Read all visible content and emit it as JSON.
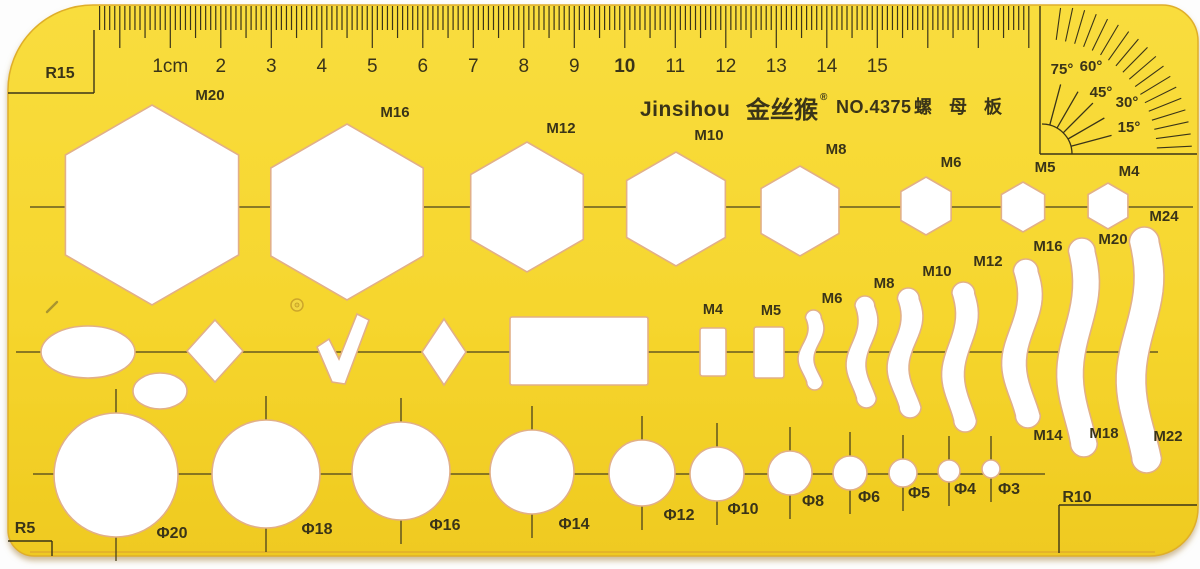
{
  "colors": {
    "background": "#fdfdfd",
    "plastic_top": "#f9dd3e",
    "plastic_mid": "#f6d62e",
    "plastic_bottom": "#efca20",
    "ink": "#3a3418",
    "line": "#4a421e",
    "cutout_fill": "#ffffff",
    "cutout_edge": "#e2b088",
    "edge_stroke": "#dfae2b",
    "shadow": "#a98545"
  },
  "brand": {
    "name_latin": "Jinsihou",
    "name_cn": "金丝猴",
    "registered": "®",
    "model": "NO.4375",
    "product": "螺 母 板"
  },
  "corner_radius_marks": {
    "top_left": "R15",
    "bottom_left": "R5",
    "bottom_right": "R10"
  },
  "ruler": {
    "labels": [
      "1cm",
      "2",
      "3",
      "4",
      "5",
      "6",
      "7",
      "8",
      "9",
      "10",
      "11",
      "12",
      "13",
      "14",
      "15"
    ],
    "first_label_x": 170.3,
    "cm_step": 50.5,
    "mm_step": 5.05,
    "tick_start_mm": -4,
    "tick_end_mm": 180,
    "top_y": 6
  },
  "protractor": {
    "origin": {
      "x": 1042,
      "y": 154
    },
    "box_v": {
      "x": 1040,
      "y1": 6,
      "y2": 154
    },
    "box_h": {
      "y": 154,
      "x1": 1040,
      "x2": 1197
    },
    "arc_r": 30,
    "ray_angles": [
      15,
      30,
      45,
      60,
      75
    ],
    "ray_r1": 30,
    "ray_r2": 72,
    "hatch_r1": 115,
    "hatch_r2": 150,
    "labels": [
      {
        "text": "75°",
        "x": 1062,
        "y": 74
      },
      {
        "text": "60°",
        "x": 1091,
        "y": 71
      },
      {
        "text": "45°",
        "x": 1101,
        "y": 97
      },
      {
        "text": "30°",
        "x": 1127,
        "y": 107
      },
      {
        "text": "15°",
        "x": 1129,
        "y": 132
      }
    ]
  },
  "guidelines": {
    "hex_row": {
      "y": 207,
      "x1": 30,
      "x2": 1193
    },
    "shape_row": {
      "y": 352,
      "x1": 16,
      "x2": 1158
    },
    "circle_row": {
      "y": 474,
      "x1": 33,
      "x2": 1045
    }
  },
  "hexagons": [
    {
      "label": "M20",
      "cx": 152,
      "cy": 205,
      "r": 100,
      "lx": 210,
      "ly": 100
    },
    {
      "label": "M16",
      "cx": 347,
      "cy": 212,
      "r": 88,
      "lx": 395,
      "ly": 117
    },
    {
      "label": "M12",
      "cx": 527,
      "cy": 207,
      "r": 65,
      "lx": 561,
      "ly": 133
    },
    {
      "label": "M10",
      "cx": 676,
      "cy": 209,
      "r": 57,
      "lx": 709,
      "ly": 140
    },
    {
      "label": "M8",
      "cx": 800,
      "cy": 211,
      "r": 45,
      "lx": 836,
      "ly": 154
    },
    {
      "label": "M6",
      "cx": 926,
      "cy": 206,
      "r": 29,
      "lx": 951,
      "ly": 167
    },
    {
      "label": "M5",
      "cx": 1023,
      "cy": 207,
      "r": 25,
      "lx": 1045,
      "ly": 172
    },
    {
      "label": "M4",
      "cx": 1108,
      "cy": 206,
      "r": 23,
      "lx": 1129,
      "ly": 176
    }
  ],
  "slot_curves": [
    {
      "label": "M6",
      "cx": 811,
      "y1": 310,
      "y2": 390,
      "w": 16,
      "amp": 5,
      "lx": 832,
      "ly": 303
    },
    {
      "label": "M8",
      "cx": 862,
      "y1": 296,
      "y2": 408,
      "w": 20,
      "amp": 6,
      "lx": 884,
      "ly": 288
    },
    {
      "label": "M10",
      "cx": 905,
      "y1": 288,
      "y2": 418,
      "w": 22,
      "amp": 7,
      "lx": 937,
      "ly": 276
    },
    {
      "label": "M12",
      "cx": 960,
      "y1": 282,
      "y2": 432,
      "w": 23,
      "amp": 7,
      "lx": 988,
      "ly": 266
    },
    {
      "label": "M16",
      "cx": 1022,
      "y1": 259,
      "y2": 428,
      "w": 25,
      "amp": 8,
      "lx": 1048,
      "ly": 251,
      "label2": "M14",
      "l2x": 1048,
      "l2y": 440
    },
    {
      "label": "M20",
      "cx": 1078,
      "y1": 238,
      "y2": 457,
      "w": 27,
      "amp": 8,
      "lx": 1113,
      "ly": 244,
      "label2": "M18",
      "l2x": 1104,
      "l2y": 438
    },
    {
      "label": "M24",
      "cx": 1140,
      "y1": 227,
      "y2": 473,
      "w": 30,
      "amp": 9,
      "lx": 1164,
      "ly": 221,
      "label2": "M22",
      "l2x": 1168,
      "l2y": 441
    }
  ],
  "small_rect_slots": [
    {
      "label": "M4",
      "x": 700,
      "y": 328,
      "w": 26,
      "h": 48,
      "lx": 713,
      "ly": 314
    },
    {
      "label": "M5",
      "x": 754,
      "y": 327,
      "w": 30,
      "h": 51,
      "lx": 771,
      "ly": 315
    }
  ],
  "circles": [
    {
      "label": "Φ20",
      "cx": 116,
      "cy": 475,
      "r": 62,
      "lx": 172,
      "ly": 538
    },
    {
      "label": "Φ18",
      "cx": 266,
      "cy": 474,
      "r": 54,
      "lx": 317,
      "ly": 534
    },
    {
      "label": "Φ16",
      "cx": 401,
      "cy": 471,
      "r": 49,
      "lx": 445,
      "ly": 530
    },
    {
      "label": "Φ14",
      "cx": 532,
      "cy": 472,
      "r": 42,
      "lx": 574,
      "ly": 529
    },
    {
      "label": "Φ12",
      "cx": 642,
      "cy": 473,
      "r": 33,
      "lx": 679,
      "ly": 520
    },
    {
      "label": "Φ10",
      "cx": 717,
      "cy": 474,
      "r": 27,
      "lx": 743,
      "ly": 514
    },
    {
      "label": "Φ8",
      "cx": 790,
      "cy": 473,
      "r": 22,
      "lx": 813,
      "ly": 506
    },
    {
      "label": "Φ6",
      "cx": 850,
      "cy": 473,
      "r": 17,
      "lx": 869,
      "ly": 502
    },
    {
      "label": "Φ5",
      "cx": 903,
      "cy": 473,
      "r": 14,
      "lx": 919,
      "ly": 498
    },
    {
      "label": "Φ4",
      "cx": 949,
      "cy": 471,
      "r": 11,
      "lx": 965,
      "ly": 494
    },
    {
      "label": "Φ3",
      "cx": 991,
      "cy": 469,
      "r": 9,
      "lx": 1009,
      "ly": 494
    }
  ],
  "freeform_shapes": {
    "rectangle": {
      "x": 510,
      "y": 317,
      "w": 138,
      "h": 68
    },
    "ellipse_large": {
      "cx": 88,
      "cy": 352,
      "rx": 47,
      "ry": 26
    },
    "ellipse_small": {
      "cx": 160,
      "cy": 391,
      "rx": 27,
      "ry": 18
    },
    "diamond_wide": {
      "cx": 215,
      "cy": 351,
      "hw": 28,
      "hh": 31
    },
    "diamond_narrow": {
      "cx": 444,
      "cy": 352,
      "hw": 22,
      "hh": 33
    },
    "checkmark_pts": [
      [
        317,
        347
      ],
      [
        329,
        339
      ],
      [
        339,
        359
      ],
      [
        357,
        314
      ],
      [
        369,
        320
      ],
      [
        345,
        384
      ],
      [
        332,
        382
      ]
    ]
  },
  "blemishes": {
    "mold_hole": {
      "cx": 297,
      "cy": 305,
      "r": 6
    },
    "scratch": {
      "x1": 57,
      "y1": 302,
      "x2": 47,
      "y2": 312
    }
  },
  "corner_boxes": {
    "r15": {
      "text_x": 60,
      "text_y": 78,
      "h_line": {
        "y": 93,
        "x1": 8,
        "x2": 94
      },
      "v_line": {
        "x": 94,
        "y1": 30,
        "y2": 93
      }
    },
    "r5": {
      "text_x": 25,
      "text_y": 533,
      "h_line": {
        "y": 541,
        "x1": 8,
        "x2": 52
      },
      "v_line": {
        "x": 52,
        "y1": 541,
        "y2": 556
      }
    },
    "r10": {
      "text_x": 1077,
      "text_y": 502,
      "h_line": {
        "y": 505,
        "x1": 1059,
        "x2": 1197
      },
      "v_line": {
        "x": 1059,
        "y1": 505,
        "y2": 553
      }
    }
  },
  "brand_layout": {
    "latin_x": 640,
    "latin_y": 116,
    "cn_x": 746,
    "cn_y": 118,
    "reg_x": 820,
    "reg_y": 100,
    "model_x": 836,
    "model_y": 113,
    "product_x": 914,
    "product_y": 113
  }
}
